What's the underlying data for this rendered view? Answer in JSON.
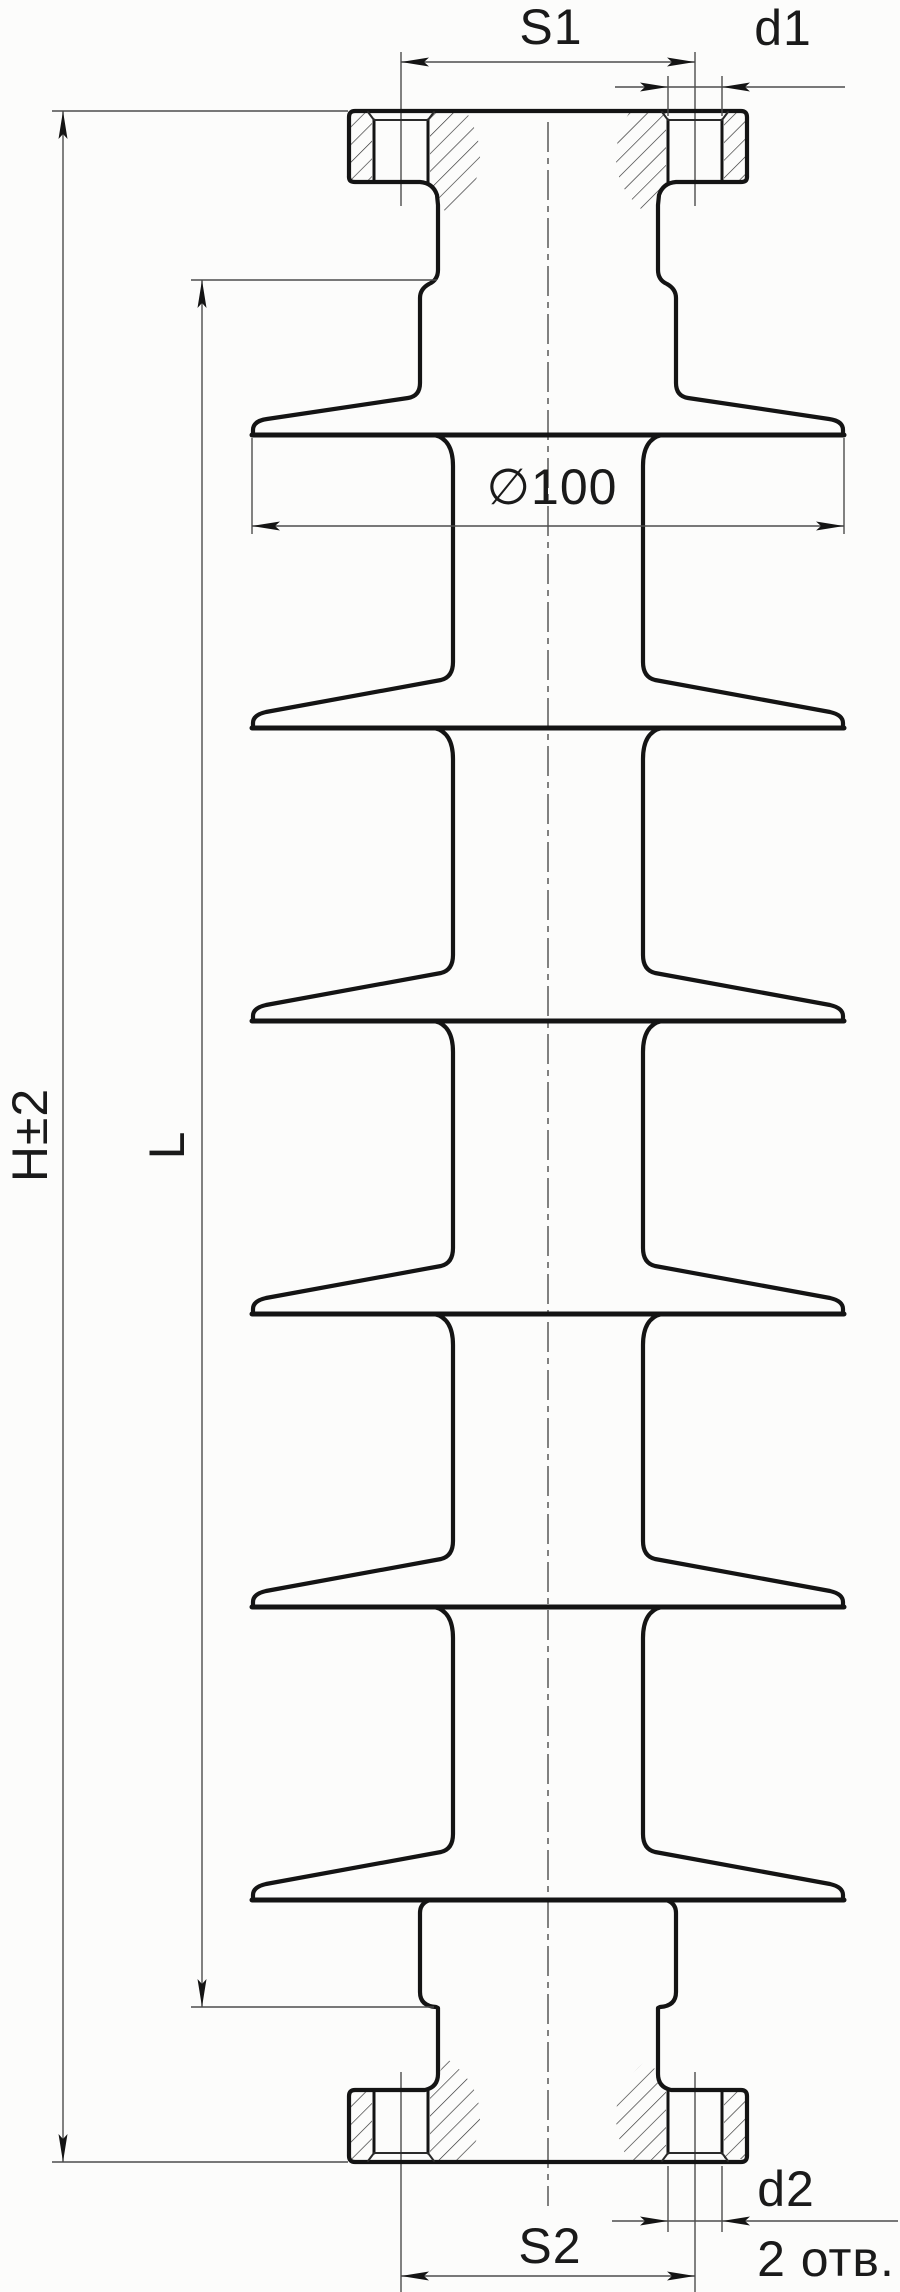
{
  "figure": {
    "kind": "engineering-drawing",
    "shed_count": 6,
    "holes_per_flange": 2
  },
  "labels": {
    "s1": "S1",
    "d1": "d1",
    "overall_height": "H±2",
    "insulating_length": "L",
    "shed_diameter": "∅100",
    "d2": "d2",
    "s2": "S2",
    "holes_note": "2 отв."
  },
  "colors": {
    "ink": "#141414",
    "thin_line": "#4d4d4d",
    "paper": "#fcfcfb"
  }
}
